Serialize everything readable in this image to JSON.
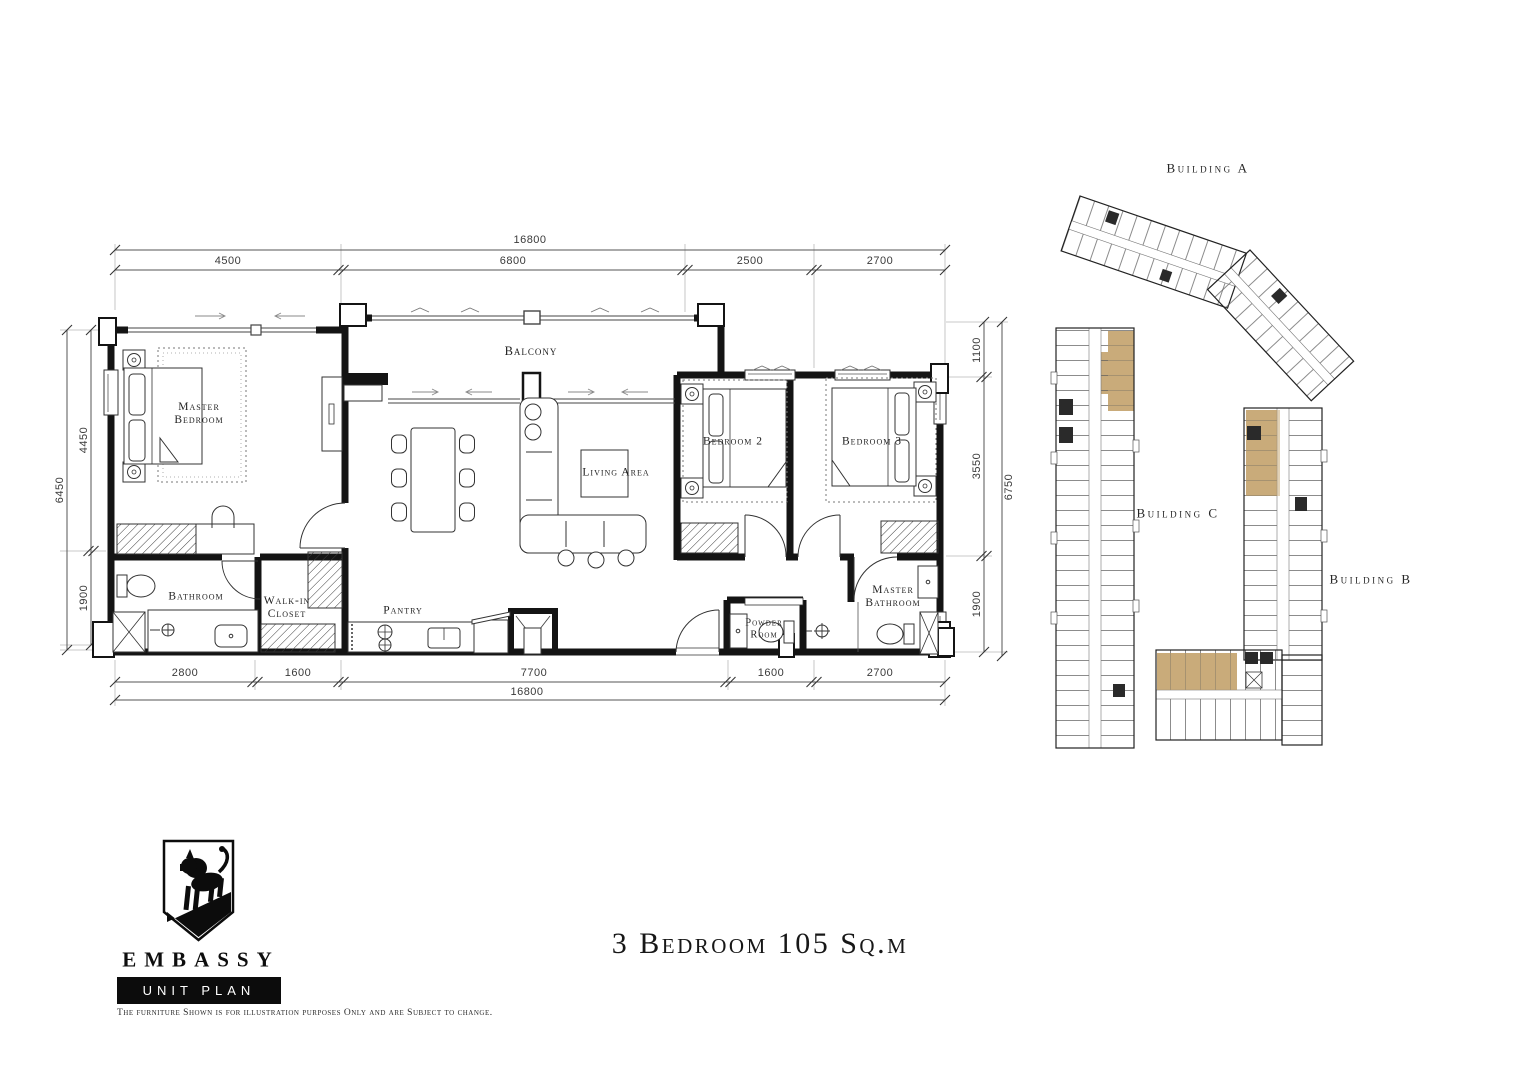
{
  "unit": {
    "title": "3 Bedroom 105 Sq.m"
  },
  "brand": {
    "name": "EMBASSY",
    "plan_label": "UNIT PLAN",
    "logo_icon": "lion-crest-icon"
  },
  "disclaimer": "The furniture Shown is for illustration purposes Only and are Subject to change.",
  "floor_plan": {
    "rooms": {
      "master_bedroom": "Master Bedroom",
      "bathroom": "Bathroom",
      "walk_in_closet": "Walk-in Closet",
      "pantry": "Pantry",
      "balcony": "Balcony",
      "living_area": "Living Area",
      "bedroom_2": "Bedroom 2",
      "bedroom_3": "Bedroom 3",
      "powder_room": "Powder Room",
      "master_bathroom": "Master Bathroom"
    },
    "dimensions": {
      "top": {
        "total": "16800",
        "segments": [
          "4500",
          "6800",
          "2500",
          "2700"
        ]
      },
      "bottom": {
        "total": "16800",
        "segments": [
          "2800",
          "1600",
          "7700",
          "1600",
          "2700"
        ]
      },
      "left": {
        "total": "6450",
        "segments": [
          "4450",
          "1900"
        ]
      },
      "right": {
        "total": "6750",
        "segments": [
          "1100",
          "3550",
          "1900"
        ]
      }
    }
  },
  "site_plan": {
    "buildings": {
      "a": "Building A",
      "b": "Building B",
      "c": "Building C"
    },
    "highlight_color": "#c9ab7a"
  }
}
